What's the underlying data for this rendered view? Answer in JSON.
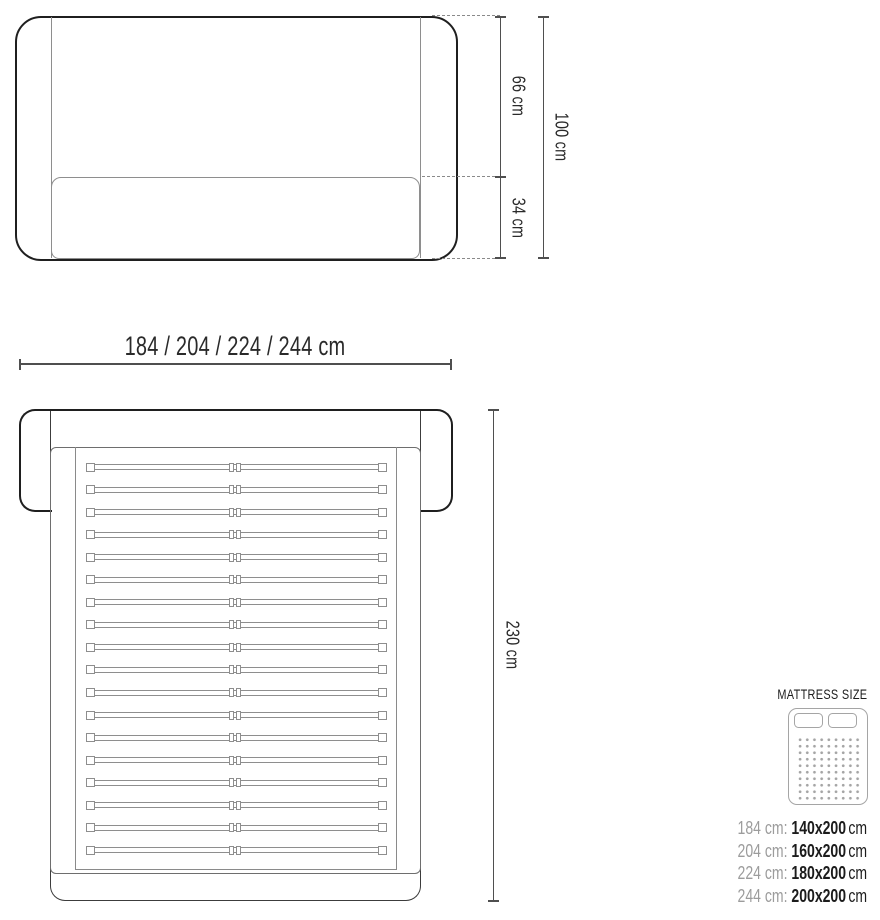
{
  "front_view": {
    "upper_height_label": "66 cm",
    "lower_height_label": "34 cm",
    "total_height_label": "100 cm"
  },
  "width_dimension": {
    "label": "184 / 204 / 224 / 244 cm"
  },
  "top_view": {
    "length_label": "230 cm",
    "slat_count": 18
  },
  "legend": {
    "title": "MATTRESS SIZE",
    "rows": [
      {
        "frame": "184 cm:",
        "mattress": "140x200",
        "unit": "cm"
      },
      {
        "frame": "204 cm:",
        "mattress": "160x200",
        "unit": "cm"
      },
      {
        "frame": "224 cm:",
        "mattress": "180x200",
        "unit": "cm"
      },
      {
        "frame": "244 cm:",
        "mattress": "200x200",
        "unit": "cm"
      }
    ]
  },
  "colors": {
    "outline": "#1f1f1f",
    "frame": "#3c3c3c",
    "secondary": "#8e8e8e",
    "inner": "#6e6e6e",
    "dimension": "#4f4f4f",
    "dash": "#8a8a8a",
    "text": "#2a2a2a",
    "legend_gray": "#9c9c9c",
    "legend_dark": "#1c1c1c",
    "icon": "#a5a5a5"
  }
}
